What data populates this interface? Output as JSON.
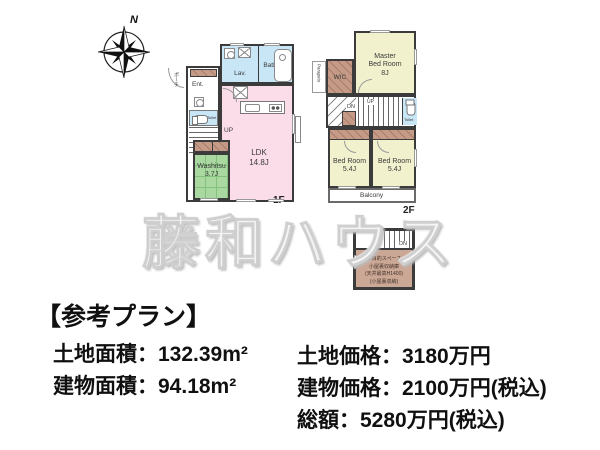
{
  "compass": {
    "north": "N"
  },
  "watermark": {
    "text": "藤和ハウス"
  },
  "floor1": {
    "label": "1F",
    "lav": "Lav.",
    "bath": "Bath",
    "ent": "Ent.",
    "toilet": "Toilet",
    "up": "UP",
    "porch": "ポーチ",
    "ldk_name": "LDK",
    "ldk_size": "14.8J",
    "washitsu_name": "Washitsu",
    "washitsu_size": "3.7J"
  },
  "floor2": {
    "label": "2F",
    "parapet": "Parapeto",
    "wic": "WIC",
    "master_line1": "Master",
    "master_line2": "Bed Room",
    "master_size": "8J",
    "dn": "DN",
    "up": "UP",
    "toilet": "Toilet",
    "bedroom_left_name": "Bed Room",
    "bedroom_left_size": "5.4J",
    "bedroom_right_name": "Bed Room",
    "bedroom_right_size": "5.4J",
    "balcony": "Balcony"
  },
  "attic": {
    "dn": "DN",
    "line1": "多目的スペース",
    "line2": "小屋裏収納庫",
    "line3": "(天井最高H1400)",
    "line4": "(小屋裏収納)"
  },
  "info": {
    "title": "【参考プラン】",
    "land_area": "土地面積：132.39m²",
    "building_area": "建物面積：94.18m²",
    "land_price": "土地価格：3180万円",
    "building_price": "建物価格：2100万円(税込)",
    "total_price": "総額：5280万円(税込)"
  },
  "colors": {
    "ldk_pink": "#fadde9",
    "tatami_green": "#a9d9a1",
    "wet_area_blue": "#c8e6f6",
    "bedroom_yellow": "#f1f2cd",
    "closet_brown": "#c59b88",
    "attic_brown": "#cba795",
    "wall": "#3b3b3b"
  }
}
